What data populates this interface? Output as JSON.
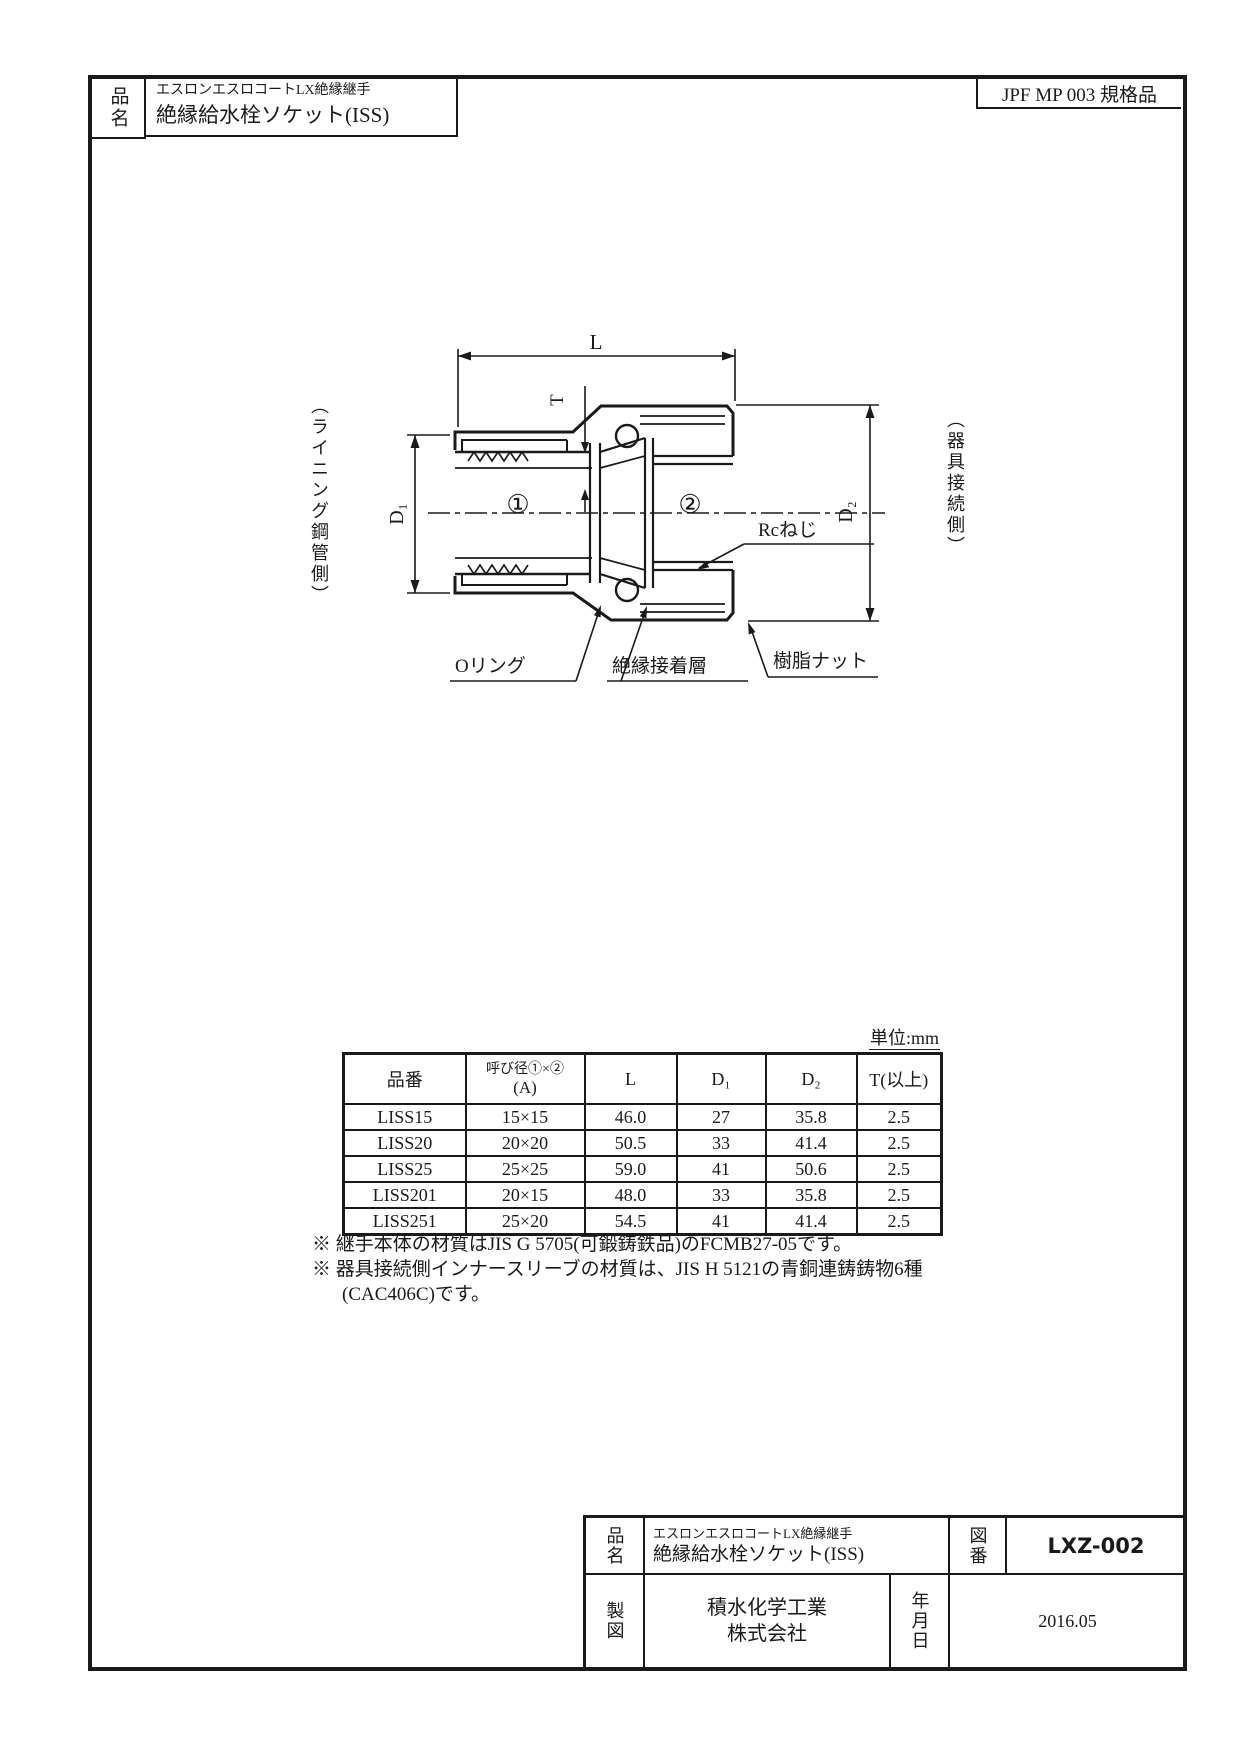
{
  "title_block_top": {
    "field_label": "品名",
    "series": "エスロンエスロコートLX絶縁継手",
    "product": "絶縁給水栓ソケット(ISS)"
  },
  "standard_badge": "JPF MP 003 規格品",
  "drawing": {
    "dim_length": "L",
    "dim_thickness": "T",
    "dim_d1": "D₁",
    "dim_d2": "D₂",
    "bore_mark_1": "①",
    "bore_mark_2": "②",
    "label_rc_thread": "Rcねじ",
    "label_o_ring": "Oリング",
    "label_adhesive_layer": "絶縁接着層",
    "label_resin_nut": "樹脂ナット",
    "side_label_left": "（ライニング鋼管側）",
    "side_label_right": "（器具接続側）"
  },
  "table": {
    "unit_note": "単位:mm",
    "headers": {
      "part_no": "品番",
      "dia_line1": "呼び径①×②",
      "dia_line2": "(A)",
      "length": "L",
      "d1": "D₁",
      "d2": "D₂",
      "thickness": "T(以上)"
    },
    "rows": [
      [
        "LISS15",
        "15×15",
        "46.0",
        "27",
        "35.8",
        "2.5"
      ],
      [
        "LISS20",
        "20×20",
        "50.5",
        "33",
        "41.4",
        "2.5"
      ],
      [
        "LISS25",
        "25×25",
        "59.0",
        "41",
        "50.6",
        "2.5"
      ],
      [
        "LISS201",
        "20×15",
        "48.0",
        "33",
        "35.8",
        "2.5"
      ],
      [
        "LISS251",
        "25×20",
        "54.5",
        "41",
        "41.4",
        "2.5"
      ]
    ]
  },
  "notes": [
    "※ 継手本体の材質はJIS G 5705(可鍛鋳鉄品)のFCMB27-05です。",
    "※ 器具接続側インナースリーブの材質は、JIS H 5121の青銅連鋳鋳物6種",
    "(CAC406C)です。"
  ],
  "title_block_bottom": {
    "name_label": "品名",
    "series": "エスロンエスロコートLX絶縁継手",
    "product": "絶縁給水栓ソケット(ISS)",
    "drawing_no_label": "図番",
    "drawing_no": "LXZ-002",
    "drafting_label": "製図",
    "company_line1": "積水化学工業",
    "company_line2": "株式会社",
    "date_label": "年月日",
    "date": "2016.05"
  },
  "colors": {
    "line": "#1a1a1a",
    "background": "#ffffff"
  }
}
